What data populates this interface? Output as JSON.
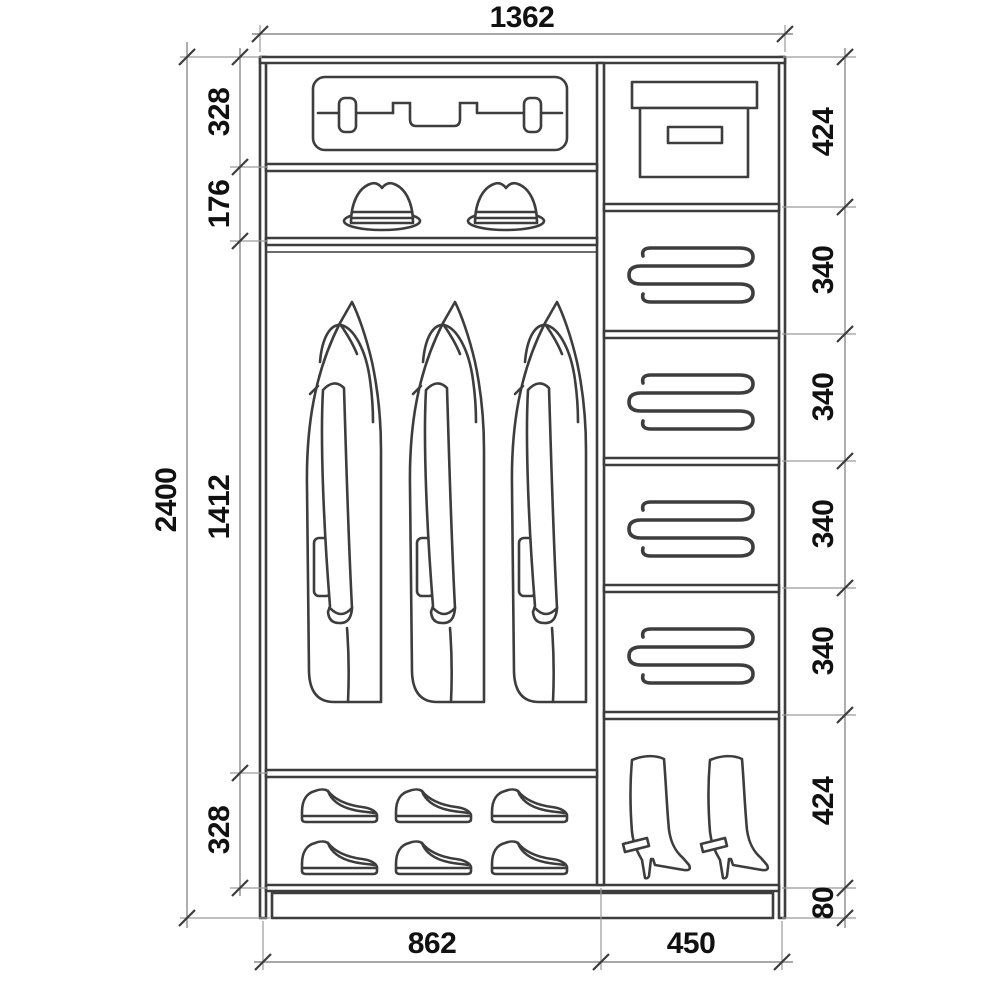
{
  "diagram": {
    "type": "wardrobe-interior-elevation",
    "units": "mm",
    "dims": {
      "total_width": "1362",
      "total_height": "2400",
      "left_column": [
        "328",
        "176",
        "1412",
        "328"
      ],
      "right_column": [
        "424",
        "340",
        "340",
        "340",
        "340",
        "424",
        "80"
      ],
      "bottom": [
        "862",
        "450"
      ]
    },
    "compartments": {
      "left": [
        "suitcase",
        "hats",
        "hanging-coats",
        "shoes"
      ],
      "right": [
        "storage-box",
        "folded-linen",
        "folded-linen",
        "folded-linen",
        "folded-linen",
        "boots"
      ]
    },
    "colors": {
      "line": "#3d3d3d",
      "dimension": "#8c8c8c",
      "text": "#111111",
      "background": "#ffffff"
    }
  }
}
